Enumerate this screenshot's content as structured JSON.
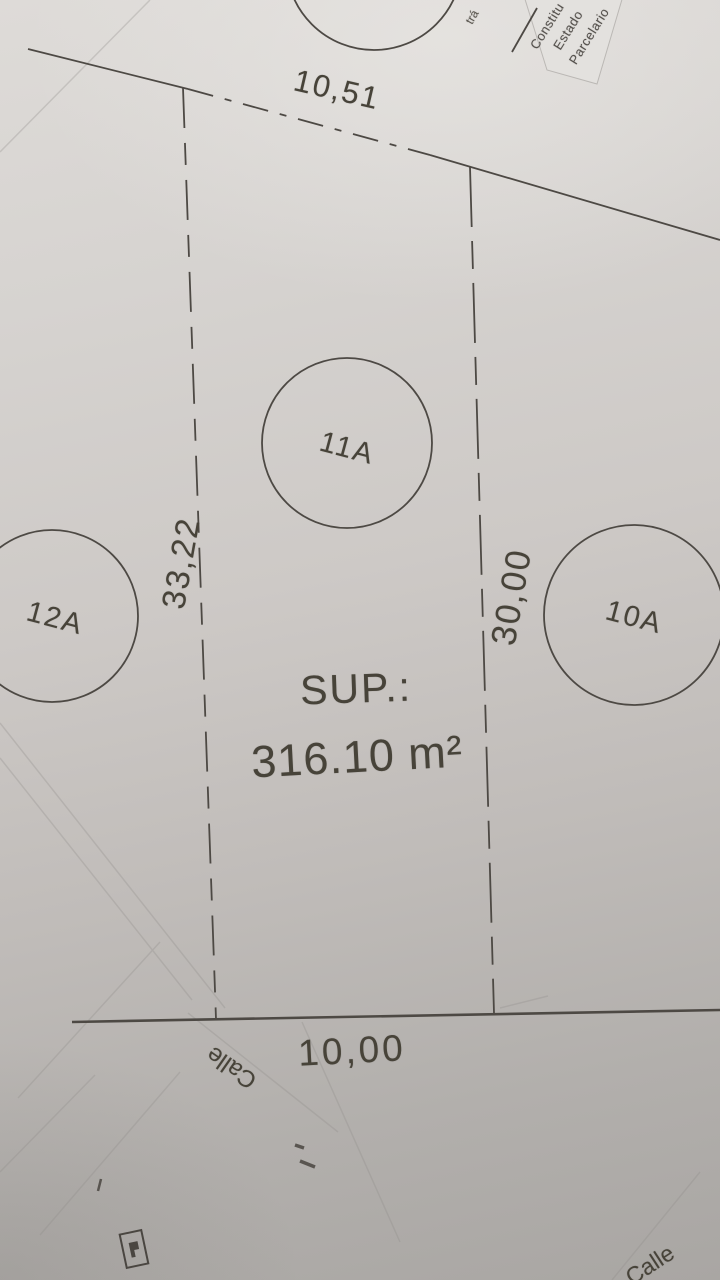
{
  "plan": {
    "dimensions": {
      "top": "10,51",
      "left": "33,22",
      "right": "30,00",
      "bottom": "10,00"
    },
    "parcels": [
      {
        "id": "11A"
      },
      {
        "id": "12A"
      },
      {
        "id": "10A"
      }
    ],
    "surface": {
      "label": "SUP.:",
      "value": "316.10 m²"
    },
    "streets": {
      "bottom": "Calle",
      "corner": "Calle"
    },
    "stamp": {
      "line1": "Constitu",
      "line2": "Estado",
      "line3": "Parcelario"
    },
    "margin_note": "trá",
    "colors": {
      "ink": "#4a4641",
      "paper_light": "#dcd9d6",
      "paper_dark": "#a8a5a2",
      "stamp_paper": "#e3e1de"
    }
  }
}
